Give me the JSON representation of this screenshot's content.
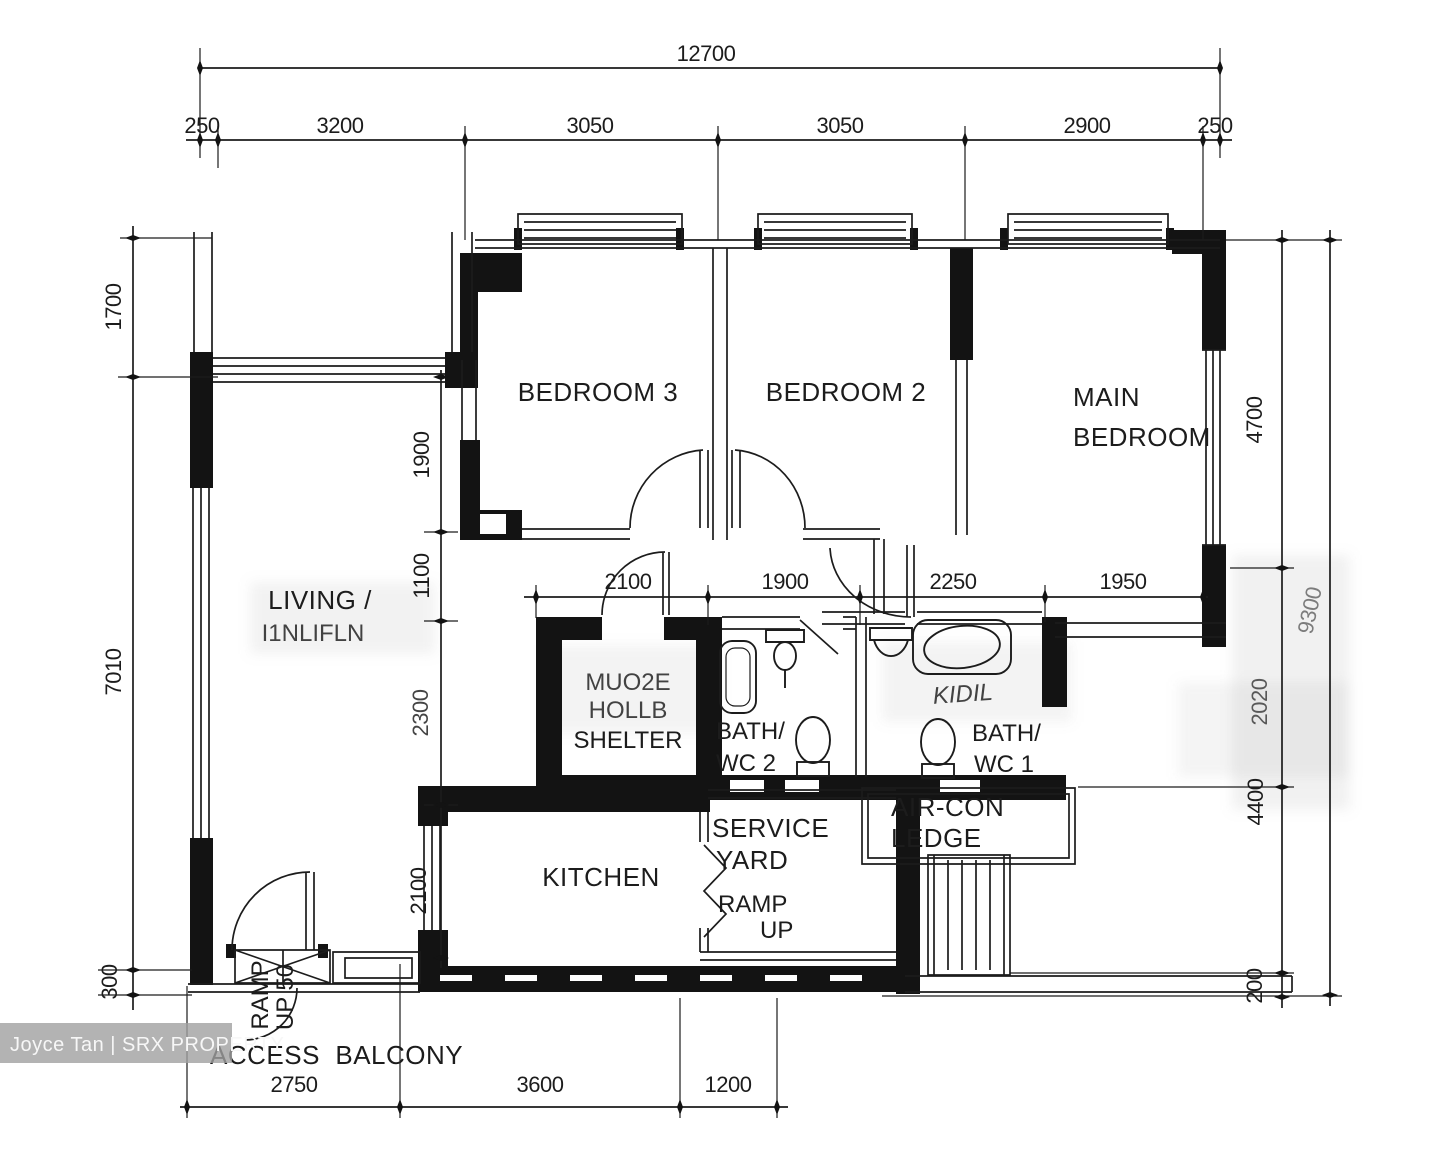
{
  "watermark": {
    "label": "Joyce Tan | SRX PROPERTY"
  },
  "rooms": {
    "bedroom3": {
      "label": "BEDROOM 3"
    },
    "bedroom2": {
      "label": "BEDROOM 2"
    },
    "main_bedroom": {
      "line1": "MAIN",
      "line2": "BEDROOM"
    },
    "living_dining": {
      "line1": "LIVING /",
      "line2": "I1NLIFLN"
    },
    "household_shelter": {
      "line1": "MUO2E",
      "line2": "HOLLB",
      "line3": "SHELTER"
    },
    "bath_wc2": {
      "line1": "BATH/",
      "line2": "WC 2"
    },
    "bath_wc1": {
      "line1": "BATH/",
      "line2": "WC 1"
    },
    "kitchen": {
      "label": "KITCHEN"
    },
    "service_yard": {
      "line1": "SERVICE",
      "line2": "YARD"
    },
    "ramp_up": {
      "line1": "RAMP",
      "line2": "UP"
    },
    "aircon_ledge": {
      "line1": "AIR-CON",
      "line2": "LEDGE"
    },
    "access_balcony": {
      "label": "ACCESS  BALCONY"
    },
    "ramp_up_50": {
      "line1": "RAMP",
      "line2": "UP 50"
    },
    "artifact_bath1": "KIDIL"
  },
  "dimensions": {
    "top_total": "12700",
    "top_chain": [
      "250",
      "3200",
      "3050",
      "3050",
      "2900",
      "250"
    ],
    "left_chain": [
      "1700",
      "7010",
      "300"
    ],
    "right_chain": [
      "4700",
      "2020",
      "4400",
      "200"
    ],
    "right_total": "9300",
    "inner_vertical": [
      "1900",
      "1100",
      "2300",
      "2100"
    ],
    "mid_chain": [
      "2100",
      "1900",
      "2250",
      "1950"
    ],
    "bottom_chain": [
      "2750",
      "3600",
      "1200"
    ]
  },
  "colors": {
    "ink": "#1c1c1c",
    "wall": "#131313",
    "watermark_bg": "#a0a0a0",
    "watermark_text": "#f7f7f7"
  }
}
